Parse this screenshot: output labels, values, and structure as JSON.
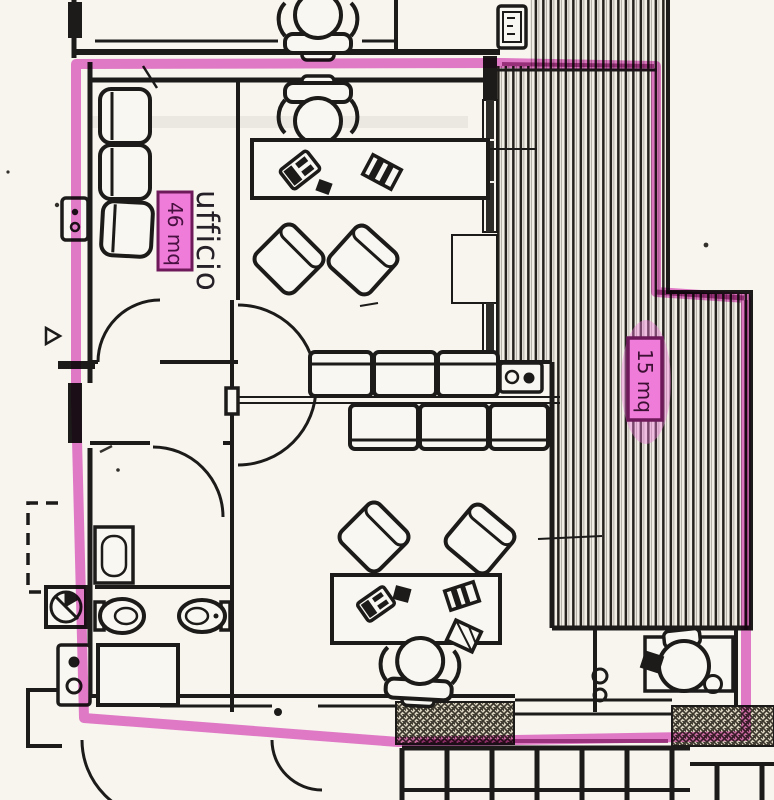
{
  "document": {
    "kind": "scanned architectural floor plan",
    "orientation": "portrait"
  },
  "labels": {
    "office": {
      "name": "ufficio",
      "area": "46 mq"
    },
    "terrace": {
      "area": "15 mq"
    }
  },
  "colors": {
    "highlighter_pink": "#e05ac6",
    "highlighter_dark": "#8f2374",
    "label_box_fill": "#ee7cd8",
    "label_box_border": "#6e1a5a",
    "ink": "#1d1b1a",
    "paper": "#f7f5ee"
  },
  "symbols": [
    "office-chair",
    "guest-chair",
    "waiting-chair",
    "desk",
    "sofa",
    "sink",
    "toilet",
    "bidet",
    "shower",
    "extractor-fan",
    "door-swing",
    "double-door",
    "staircase",
    "terrace-decking",
    "masonry-crosshatch",
    "window",
    "pillar"
  ]
}
